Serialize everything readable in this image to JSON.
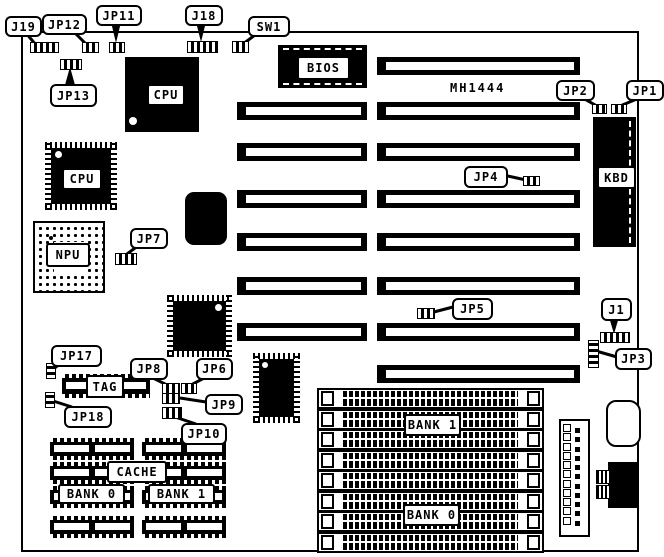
{
  "board": {
    "model_text": "MH1444",
    "ink": "#000000",
    "paper": "#ffffff",
    "outline": {
      "x": 21,
      "y": 31,
      "w": 614,
      "h": 517
    },
    "model_pos": {
      "x": 450,
      "y": 81
    }
  },
  "callouts": [
    {
      "label": "J19",
      "box": [
        5,
        16,
        33,
        17
      ],
      "jumper": [
        30,
        42,
        27,
        9,
        "h"
      ],
      "tail": {
        "line": [
          26,
          33,
          36,
          45
        ]
      }
    },
    {
      "label": "JP12",
      "box": [
        42,
        14,
        41,
        17
      ],
      "jumper": [
        82,
        42,
        15,
        9,
        "h"
      ],
      "tail": {
        "line": [
          73,
          31,
          87,
          45
        ]
      }
    },
    {
      "label": "JP11",
      "box": [
        96,
        5,
        42,
        17
      ],
      "jumper": [
        109,
        42,
        14,
        9,
        "h"
      ],
      "tail": {
        "tri": "111,22 121,22 116,43"
      }
    },
    {
      "label": "J18",
      "box": [
        185,
        5,
        34,
        17
      ],
      "jumper": [
        187,
        41,
        29,
        10,
        "h"
      ],
      "tail": {
        "tri": "196,22 206,22 201,42"
      }
    },
    {
      "label": "SW1",
      "box": [
        248,
        16,
        38,
        17
      ],
      "jumper": [
        232,
        41,
        15,
        10,
        "h"
      ],
      "tail": {
        "line": [
          259,
          32,
          243,
          44
        ]
      }
    },
    {
      "label": "JP13",
      "box": [
        50,
        84,
        43,
        19
      ],
      "jumper": [
        60,
        59,
        20,
        9,
        "h"
      ],
      "tail": {
        "tri": "65,85 75,85 70,67"
      }
    },
    {
      "label": "JP2",
      "box": [
        556,
        80,
        35,
        17
      ],
      "jumper": [
        592,
        104,
        13,
        8,
        "h"
      ],
      "tail": {
        "line": [
          579,
          96,
          597,
          106
        ]
      }
    },
    {
      "label": "JP1",
      "box": [
        626,
        80,
        34,
        17
      ],
      "jumper": [
        611,
        104,
        14,
        8,
        "h"
      ],
      "tail": {
        "line": [
          644,
          96,
          620,
          106
        ]
      }
    },
    {
      "label": "JP4",
      "box": [
        464,
        166,
        40,
        18
      ],
      "jumper": [
        523,
        176,
        15,
        8,
        "h"
      ],
      "tail": {
        "line": [
          503,
          175,
          526,
          180
        ]
      }
    },
    {
      "label": "JP5",
      "box": [
        452,
        298,
        37,
        18
      ],
      "jumper": [
        417,
        308,
        16,
        9,
        "h"
      ],
      "tail": {
        "line": [
          453,
          307,
          430,
          313
        ]
      }
    },
    {
      "label": "J1",
      "box": [
        601,
        298,
        27,
        19
      ],
      "jumper": [
        600,
        332,
        28,
        9,
        "h"
      ],
      "tail": {
        "tri": "609,317 619,317 614,334"
      }
    },
    {
      "label": "JP3",
      "box": [
        615,
        348,
        33,
        18
      ],
      "jumper": [
        588,
        340,
        9,
        26,
        "v"
      ],
      "tail": {
        "line": [
          617,
          357,
          596,
          351
        ]
      }
    },
    {
      "label": "JP7",
      "box": [
        130,
        228,
        34,
        17
      ],
      "jumper": [
        115,
        253,
        20,
        10,
        "h"
      ],
      "tail": {
        "line": [
          139,
          245,
          123,
          257
        ]
      }
    },
    {
      "label": "JP17",
      "box": [
        51,
        345,
        47,
        18
      ],
      "jumper": [
        46,
        363,
        8,
        14,
        "v"
      ],
      "tail": {
        "line": [
          61,
          363,
          51,
          371
        ]
      }
    },
    {
      "label": "JP18",
      "box": [
        64,
        406,
        44,
        18
      ],
      "jumper": [
        45,
        392,
        8,
        14,
        "v"
      ],
      "tail": {
        "line": [
          72,
          407,
          50,
          400
        ]
      }
    },
    {
      "label": "JP8",
      "box": [
        130,
        358,
        34,
        18
      ],
      "jumper": [
        162,
        383,
        16,
        9,
        "h"
      ],
      "tail": {
        "line": [
          149,
          376,
          169,
          386
        ]
      }
    },
    {
      "label": "JP6",
      "box": [
        196,
        358,
        33,
        18
      ],
      "jumper": [
        181,
        383,
        14,
        9,
        "h"
      ],
      "tail": {
        "line": [
          208,
          376,
          189,
          386
        ]
      }
    },
    {
      "label": "JP9",
      "box": [
        205,
        394,
        34,
        17
      ],
      "jumper": [
        162,
        393,
        16,
        9,
        "h"
      ],
      "tail": {
        "line": [
          206,
          402,
          180,
          398
        ]
      }
    },
    {
      "label": "JP10",
      "box": [
        181,
        423,
        42,
        18
      ],
      "jumper": [
        162,
        407,
        18,
        10,
        "h"
      ],
      "tail": {
        "line": [
          196,
          424,
          172,
          416
        ]
      }
    }
  ],
  "chips": [
    {
      "name": "cpu-chip-top",
      "type": "solid",
      "x": 125,
      "y": 57,
      "w": 74,
      "h": 75,
      "label": "CPU",
      "lab": [
        147,
        84,
        34,
        18
      ],
      "dot": {
        "pos": [
          4,
          60
        ],
        "size": 8
      }
    },
    {
      "name": "bios-chip",
      "type": "bios",
      "x": 278,
      "y": 45,
      "w": 89,
      "h": 43,
      "label": "BIOS",
      "lab": [
        297,
        56,
        49,
        20
      ]
    },
    {
      "name": "cpu-qfp",
      "type": "qfp",
      "x": 45,
      "y": 142,
      "w": 72,
      "h": 68,
      "label": "CPU",
      "lab": [
        62,
        168,
        36,
        18
      ],
      "dot": {
        "pos": [
          10,
          9
        ],
        "size": 7
      }
    },
    {
      "name": "npu-socket",
      "type": "npu",
      "x": 33,
      "y": 221,
      "w": 68,
      "h": 68,
      "label": "NPU",
      "lab": [
        46,
        243,
        40,
        20
      ],
      "bdot": {
        "pos": [
          14,
          13
        ],
        "size": 4
      }
    },
    {
      "name": "chip-rounded",
      "type": "rounded",
      "x": 185,
      "y": 192,
      "w": 42,
      "h": 53
    },
    {
      "name": "chip-qfp-mid",
      "type": "qfp",
      "x": 167,
      "y": 295,
      "w": 65,
      "h": 62,
      "dot": {
        "pos": [
          48,
          9
        ],
        "size": 7
      }
    },
    {
      "name": "chip-qfp-small",
      "type": "qfp",
      "x": 253,
      "y": 353,
      "w": 47,
      "h": 70,
      "dot": {
        "pos": [
          9,
          9
        ],
        "size": 6
      }
    },
    {
      "name": "kbd-controller",
      "type": "kbd",
      "x": 593,
      "y": 117,
      "w": 43,
      "h": 130,
      "label": "KBD",
      "lab": [
        597,
        166,
        35,
        19
      ]
    },
    {
      "name": "tag-ram",
      "type": "dip",
      "x": 62,
      "y": 374,
      "w": 88,
      "h": 24,
      "label": "TAG",
      "lab": [
        86,
        375,
        34,
        19
      ]
    }
  ],
  "expansion_slots": {
    "right_x": 377,
    "right_w": 203,
    "left_x": 237,
    "left_w": 130,
    "h": 18,
    "rows": [
      {
        "y": 57,
        "left": false
      },
      {
        "y": 102,
        "left": true
      },
      {
        "y": 143,
        "left": true
      },
      {
        "y": 190,
        "left": true
      },
      {
        "y": 233,
        "left": true
      },
      {
        "y": 277,
        "left": true
      },
      {
        "y": 323,
        "left": true
      },
      {
        "y": 365,
        "left": false
      }
    ]
  },
  "simm_sockets": {
    "x": 317,
    "w": 223,
    "h": 17,
    "ys": [
      388,
      409,
      429,
      450,
      470,
      491,
      511,
      532
    ],
    "bank_labels": [
      {
        "text": "BANK 1",
        "box": [
          404,
          414,
          53,
          18
        ]
      },
      {
        "text": "BANK 0",
        "box": [
          403,
          504,
          53,
          18
        ]
      }
    ]
  },
  "cache_bank": {
    "col_xs": [
      50,
      142
    ],
    "w": 84,
    "h": 22,
    "row_ys": [
      438,
      462,
      486,
      516
    ],
    "labels": [
      {
        "text": "CACHE",
        "box": [
          107,
          461,
          56,
          18
        ]
      },
      {
        "text": "BANK 0",
        "box": [
          58,
          484,
          63,
          16
        ]
      },
      {
        "text": "BANK 1",
        "box": [
          148,
          484,
          63,
          16
        ]
      }
    ]
  },
  "power_connector": {
    "x": 559,
    "y": 419,
    "w": 27,
    "h": 114,
    "pins": 11
  },
  "battery_blob": {
    "x": 606,
    "y": 400,
    "w": 31,
    "h": 43
  },
  "din_connector": {
    "body": {
      "x": 608,
      "y": 462,
      "w": 29,
      "h": 46
    },
    "plugs": [
      {
        "x": 596,
        "y": 470,
        "w": 14,
        "h": 12
      },
      {
        "x": 596,
        "y": 485,
        "w": 14,
        "h": 12
      }
    ]
  }
}
